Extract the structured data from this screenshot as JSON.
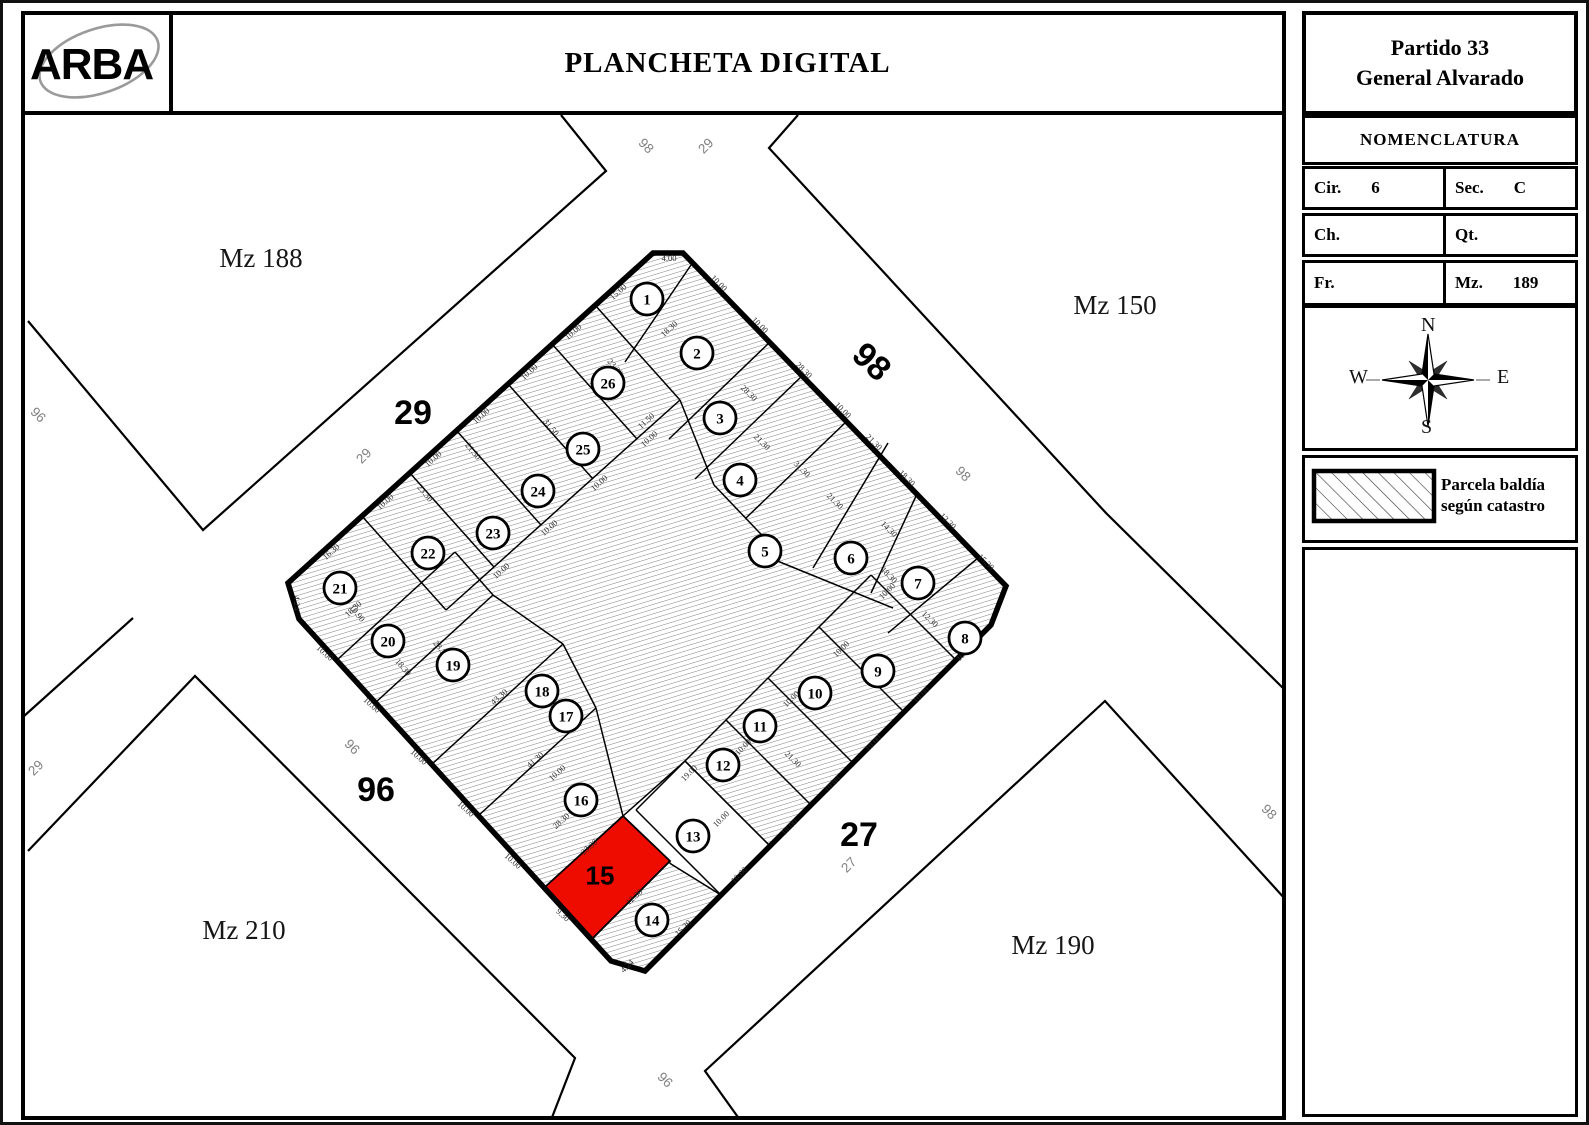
{
  "header": {
    "logo": "ARBA",
    "title": "PLANCHETA DIGITAL",
    "partido_line1": "Partido 33",
    "partido_line2": "General Alvarado"
  },
  "nomenclatura": {
    "title": "NOMENCLATURA",
    "fields": [
      {
        "label": "Cir.",
        "value": "6"
      },
      {
        "label": "Sec.",
        "value": "C"
      },
      {
        "label": "Ch.",
        "value": ""
      },
      {
        "label": "Qt.",
        "value": ""
      },
      {
        "label": "Fr.",
        "value": ""
      },
      {
        "label": "Mz.",
        "value": "189"
      }
    ]
  },
  "compass": {
    "n": "N",
    "s": "S",
    "e": "E",
    "w": "W"
  },
  "legend": {
    "line1": "Parcela baldía",
    "line2": "según catastro"
  },
  "map": {
    "colors": {
      "red": "#ee0b00",
      "gray_label": "#818181",
      "dim": "#2b2b2b"
    },
    "block_labels": [
      {
        "text": "Mz 188",
        "x": 258,
        "y": 264
      },
      {
        "text": "Mz 150",
        "x": 1112,
        "y": 311
      },
      {
        "text": "Mz 210",
        "x": 241,
        "y": 936
      },
      {
        "text": "Mz 190",
        "x": 1050,
        "y": 951
      }
    ],
    "street_labels_bold": [
      {
        "text": "29",
        "x": 410,
        "y": 421,
        "rot": 0
      },
      {
        "text": "98",
        "x": 861,
        "y": 367,
        "rot": 43
      },
      {
        "text": "96",
        "x": 373,
        "y": 798,
        "rot": 0
      },
      {
        "text": "27",
        "x": 856,
        "y": 843,
        "rot": 0
      }
    ],
    "street_labels_small": [
      {
        "text": "98",
        "x": 640,
        "y": 146,
        "rot": 45
      },
      {
        "text": "29",
        "x": 706,
        "y": 146,
        "rot": -45
      },
      {
        "text": "96",
        "x": 32,
        "y": 415,
        "rot": 45
      },
      {
        "text": "29",
        "x": 36,
        "y": 768,
        "rot": -45
      },
      {
        "text": "29",
        "x": 364,
        "y": 456,
        "rot": -45
      },
      {
        "text": "96",
        "x": 346,
        "y": 747,
        "rot": 45
      },
      {
        "text": "96",
        "x": 659,
        "y": 1080,
        "rot": 45
      },
      {
        "text": "27",
        "x": 849,
        "y": 865,
        "rot": -45
      },
      {
        "text": "98",
        "x": 957,
        "y": 474,
        "rot": 45
      },
      {
        "text": "98",
        "x": 1263,
        "y": 812,
        "rot": 45
      }
    ],
    "street_lines": [
      [
        [
          558,
          112
        ],
        [
          603,
          168
        ],
        [
          200,
          527
        ],
        [
          25,
          318
        ]
      ],
      [
        [
          795,
          112
        ],
        [
          766,
          145
        ],
        [
          1103,
          510
        ],
        [
          1283,
          688
        ]
      ],
      [
        [
          1283,
          897
        ],
        [
          1102,
          698
        ],
        [
          702,
          1068
        ],
        [
          737,
          1117
        ]
      ],
      [
        [
          25,
          848
        ],
        [
          192,
          673
        ],
        [
          572,
          1055
        ],
        [
          548,
          1117
        ]
      ],
      [
        [
          20,
          714
        ],
        [
          130,
          615
        ]
      ]
    ],
    "block_outline": [
      [
        650,
        250
      ],
      [
        680,
        250
      ],
      [
        1003,
        583
      ],
      [
        988,
        622
      ],
      [
        642,
        968
      ],
      [
        608,
        958
      ],
      [
        296,
        616
      ],
      [
        285,
        580
      ]
    ],
    "inner_lines": [
      [
        358,
        512,
        443,
        607
      ],
      [
        406,
        469,
        491,
        564
      ],
      [
        453,
        427,
        538,
        522
      ],
      [
        505,
        381,
        590,
        476
      ],
      [
        549,
        341,
        634,
        436
      ],
      [
        592,
        302,
        677,
        397
      ],
      [
        443,
        607,
        677,
        397
      ],
      [
        688,
        262,
        622,
        359
      ],
      [
        767,
        339,
        666,
        436
      ],
      [
        800,
        372,
        692,
        476
      ],
      [
        677,
        397,
        711,
        482
      ],
      [
        711,
        482,
        774,
        548
      ],
      [
        844,
        418,
        743,
        515
      ],
      [
        885,
        440,
        810,
        565
      ],
      [
        914,
        491,
        868,
        590
      ],
      [
        975,
        555,
        885,
        630
      ],
      [
        767,
        555,
        890,
        605
      ],
      [
        953,
        657,
        868,
        572
      ],
      [
        901,
        709,
        816,
        624
      ],
      [
        850,
        760,
        765,
        675
      ],
      [
        808,
        802,
        723,
        717
      ],
      [
        767,
        843,
        682,
        758
      ],
      [
        718,
        892,
        633,
        807
      ],
      [
        868,
        572,
        633,
        807
      ],
      [
        589,
        936,
        667,
        858
      ],
      [
        542,
        884,
        620,
        813
      ],
      [
        475,
        813,
        593,
        705
      ],
      [
        428,
        762,
        560,
        641
      ],
      [
        372,
        700,
        490,
        592
      ],
      [
        334,
        657,
        452,
        549
      ],
      [
        452,
        549,
        490,
        592
      ],
      [
        490,
        592,
        560,
        641
      ],
      [
        560,
        641,
        593,
        705
      ],
      [
        593,
        705,
        620,
        813
      ]
    ],
    "white_parcel": [
      [
        682,
        758
      ],
      [
        767,
        843
      ],
      [
        718,
        892
      ],
      [
        668,
        861
      ],
      [
        620,
        813
      ]
    ],
    "red_parcel": {
      "points": [
        [
          620,
          813
        ],
        [
          667,
          858
        ],
        [
          589,
          936
        ],
        [
          542,
          884
        ]
      ],
      "label": "15",
      "lx": 597,
      "ly": 872
    },
    "parcel_circles": [
      {
        "n": "1",
        "x": 644,
        "y": 296
      },
      {
        "n": "2",
        "x": 694,
        "y": 350
      },
      {
        "n": "3",
        "x": 717,
        "y": 415
      },
      {
        "n": "4",
        "x": 737,
        "y": 477
      },
      {
        "n": "5",
        "x": 762,
        "y": 548
      },
      {
        "n": "6",
        "x": 848,
        "y": 555
      },
      {
        "n": "7",
        "x": 915,
        "y": 580
      },
      {
        "n": "8",
        "x": 962,
        "y": 635
      },
      {
        "n": "9",
        "x": 875,
        "y": 668
      },
      {
        "n": "10",
        "x": 812,
        "y": 690
      },
      {
        "n": "11",
        "x": 757,
        "y": 723
      },
      {
        "n": "12",
        "x": 720,
        "y": 762
      },
      {
        "n": "13",
        "x": 690,
        "y": 833
      },
      {
        "n": "14",
        "x": 649,
        "y": 917
      },
      {
        "n": "16",
        "x": 578,
        "y": 797
      },
      {
        "n": "17",
        "x": 563,
        "y": 713
      },
      {
        "n": "18",
        "x": 539,
        "y": 688
      },
      {
        "n": "19",
        "x": 450,
        "y": 662
      },
      {
        "n": "20",
        "x": 385,
        "y": 638
      },
      {
        "n": "21",
        "x": 337,
        "y": 585
      },
      {
        "n": "22",
        "x": 425,
        "y": 550
      },
      {
        "n": "23",
        "x": 490,
        "y": 530
      },
      {
        "n": "24",
        "x": 535,
        "y": 488
      },
      {
        "n": "25",
        "x": 580,
        "y": 446
      },
      {
        "n": "26",
        "x": 605,
        "y": 380
      }
    ],
    "dim_labels": [
      {
        "t": "15.00",
        "x": 617,
        "y": 291,
        "r": -42
      },
      {
        "t": "10.00",
        "x": 572,
        "y": 331,
        "r": -42
      },
      {
        "t": "10.00",
        "x": 528,
        "y": 371,
        "r": -42
      },
      {
        "t": "10.00",
        "x": 480,
        "y": 415,
        "r": -42
      },
      {
        "t": "10.00",
        "x": 432,
        "y": 458,
        "r": -42
      },
      {
        "t": "10.00",
        "x": 384,
        "y": 501,
        "r": -42
      },
      {
        "t": "16.30",
        "x": 330,
        "y": 551,
        "r": -42
      },
      {
        "t": "4.00",
        "x": 666,
        "y": 258,
        "r": 0
      },
      {
        "t": "10.00",
        "x": 714,
        "y": 282,
        "r": 45
      },
      {
        "t": "10.00",
        "x": 755,
        "y": 324,
        "r": 45
      },
      {
        "t": "28.30",
        "x": 799,
        "y": 369,
        "r": 45
      },
      {
        "t": "10.00",
        "x": 838,
        "y": 409,
        "r": 45
      },
      {
        "t": "21.30",
        "x": 869,
        "y": 441,
        "r": 45
      },
      {
        "t": "18.30",
        "x": 902,
        "y": 477,
        "r": 45
      },
      {
        "t": "12.30",
        "x": 943,
        "y": 520,
        "r": 45
      },
      {
        "t": "15.30",
        "x": 981,
        "y": 561,
        "r": 45
      },
      {
        "t": "10.00",
        "x": 963,
        "y": 652,
        "r": -45
      },
      {
        "t": "10.00",
        "x": 920,
        "y": 694,
        "r": -45
      },
      {
        "t": "10.00",
        "x": 872,
        "y": 742,
        "r": -45
      },
      {
        "t": "10.00",
        "x": 831,
        "y": 783,
        "r": -45
      },
      {
        "t": "10.00",
        "x": 788,
        "y": 826,
        "r": -45
      },
      {
        "t": "10.00",
        "x": 738,
        "y": 874,
        "r": -45
      },
      {
        "t": "15.30",
        "x": 682,
        "y": 927,
        "r": -45
      },
      {
        "t": "4.24",
        "x": 626,
        "y": 965,
        "r": -45
      },
      {
        "t": "9.30",
        "x": 558,
        "y": 914,
        "r": 42
      },
      {
        "t": "10.00",
        "x": 508,
        "y": 860,
        "r": 42
      },
      {
        "t": "10.00",
        "x": 461,
        "y": 808,
        "r": 42
      },
      {
        "t": "10.00",
        "x": 414,
        "y": 756,
        "r": 42
      },
      {
        "t": "10.00",
        "x": 367,
        "y": 704,
        "r": 42
      },
      {
        "t": "10.00",
        "x": 320,
        "y": 652,
        "r": 42
      },
      {
        "t": "4.24",
        "x": 291,
        "y": 600,
        "r": 90
      },
      {
        "t": "18.30",
        "x": 668,
        "y": 328,
        "r": -42
      },
      {
        "t": "11.50",
        "x": 645,
        "y": 420,
        "r": -42
      },
      {
        "t": "28.30",
        "x": 744,
        "y": 392,
        "r": 45
      },
      {
        "t": "21.30",
        "x": 757,
        "y": 441,
        "r": 45
      },
      {
        "t": "31.30",
        "x": 797,
        "y": 468,
        "r": 45
      },
      {
        "t": "21.30",
        "x": 830,
        "y": 500,
        "r": 45
      },
      {
        "t": "14.30",
        "x": 884,
        "y": 528,
        "r": 45
      },
      {
        "t": "18.30",
        "x": 884,
        "y": 574,
        "r": 45
      },
      {
        "t": "12.30",
        "x": 925,
        "y": 618,
        "r": 45
      },
      {
        "t": "23.30",
        "x": 420,
        "y": 492,
        "r": 50
      },
      {
        "t": "21.30",
        "x": 468,
        "y": 450,
        "r": 50
      },
      {
        "t": "31.50",
        "x": 546,
        "y": 426,
        "r": 50
      },
      {
        "t": "23.30",
        "x": 610,
        "y": 366,
        "r": 50
      },
      {
        "t": "10.00",
        "x": 500,
        "y": 570,
        "r": -42
      },
      {
        "t": "10.00",
        "x": 548,
        "y": 527,
        "r": -42
      },
      {
        "t": "10.00",
        "x": 598,
        "y": 482,
        "r": -42
      },
      {
        "t": "10.00",
        "x": 648,
        "y": 438,
        "r": -42
      },
      {
        "t": "18.30",
        "x": 352,
        "y": 608,
        "r": -42
      },
      {
        "t": "28.30",
        "x": 436,
        "y": 648,
        "r": 50
      },
      {
        "t": "18.30",
        "x": 398,
        "y": 666,
        "r": 50
      },
      {
        "t": "43.30",
        "x": 498,
        "y": 696,
        "r": -42
      },
      {
        "t": "41.30",
        "x": 534,
        "y": 759,
        "r": -42
      },
      {
        "t": "28.30",
        "x": 560,
        "y": 820,
        "r": -42
      },
      {
        "t": "10.00",
        "x": 556,
        "y": 772,
        "r": -42
      },
      {
        "t": "23.30",
        "x": 588,
        "y": 846,
        "r": -42
      },
      {
        "t": "12.30",
        "x": 633,
        "y": 896,
        "r": -42
      },
      {
        "t": "10.00",
        "x": 720,
        "y": 818,
        "r": -45
      },
      {
        "t": "19.00",
        "x": 688,
        "y": 772,
        "r": -45
      },
      {
        "t": "21.30",
        "x": 788,
        "y": 758,
        "r": 45
      },
      {
        "t": "10.00",
        "x": 742,
        "y": 746,
        "r": -45
      },
      {
        "t": "10.00",
        "x": 790,
        "y": 698,
        "r": -45
      },
      {
        "t": "10.00",
        "x": 840,
        "y": 648,
        "r": -45
      },
      {
        "t": "10.00",
        "x": 886,
        "y": 590,
        "r": -45
      },
      {
        "t": "10.90",
        "x": 352,
        "y": 612,
        "r": 50
      }
    ]
  }
}
